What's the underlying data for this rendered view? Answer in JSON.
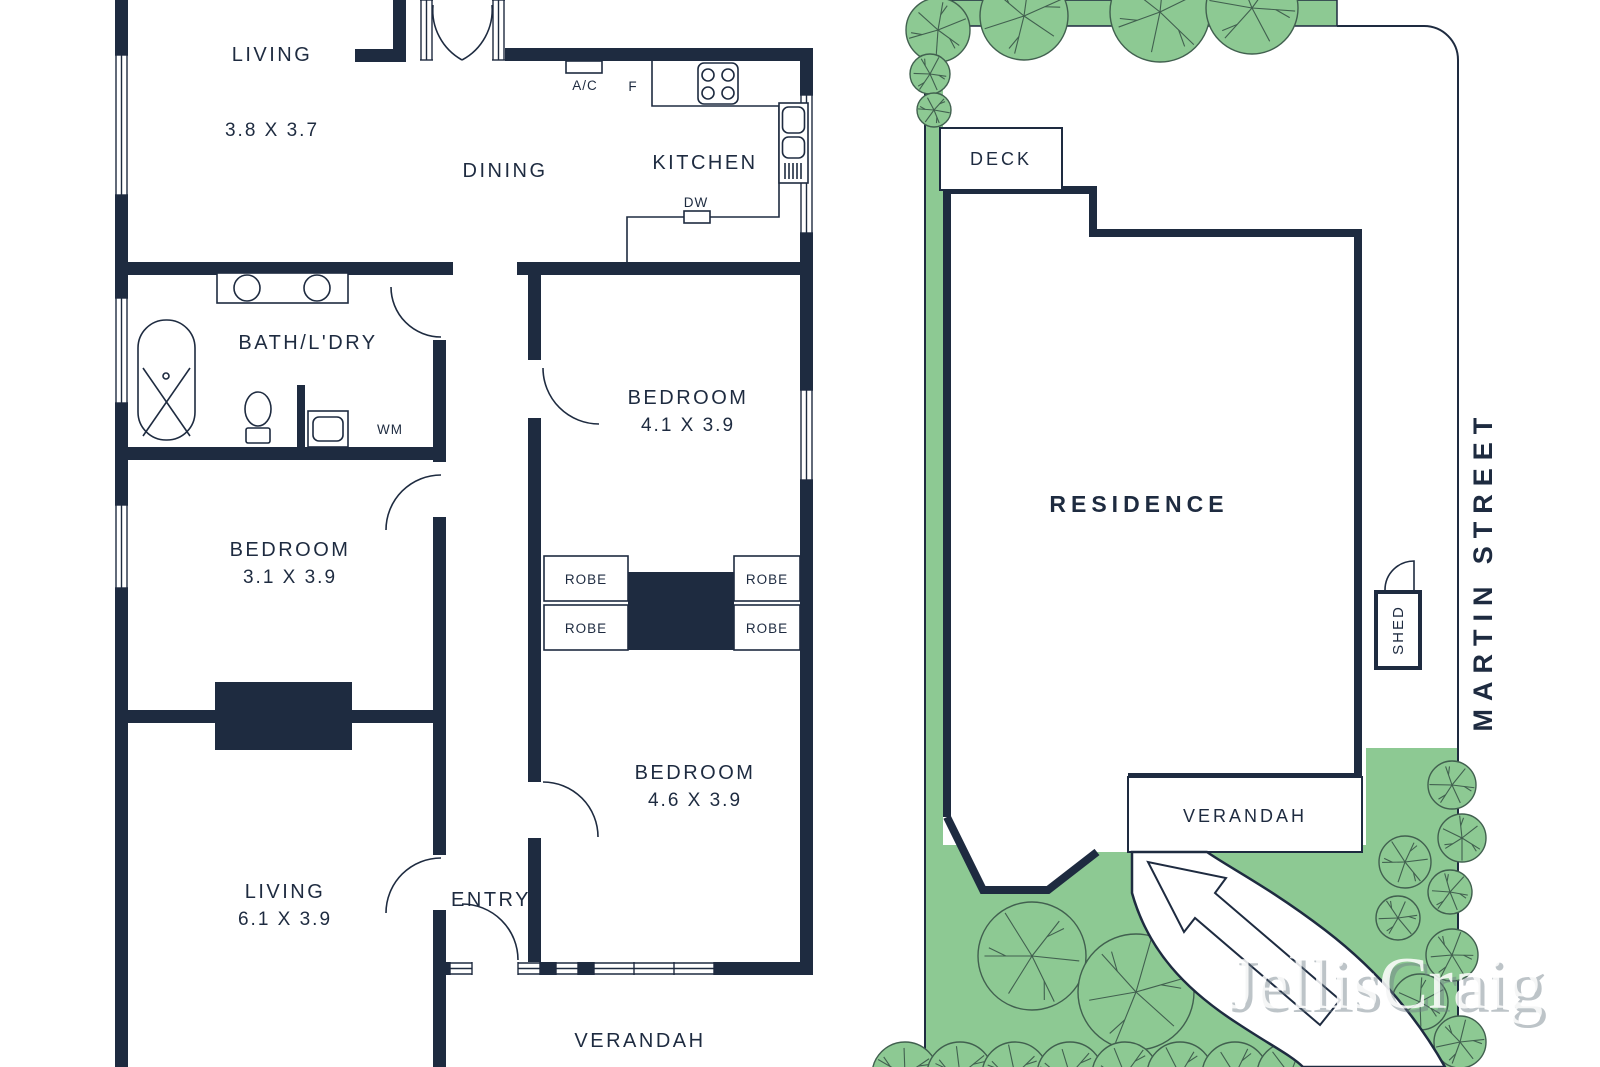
{
  "colors": {
    "wall": "#1e2b40",
    "grass": "#8dc993",
    "tree_outline": "#41604f",
    "paper": "#ffffff"
  },
  "floor_plan": {
    "rooms": {
      "living_top": {
        "name": "LIVING",
        "dims": "3.8 X 3.7"
      },
      "dining": {
        "name": "DINING"
      },
      "kitchen": {
        "name": "KITCHEN"
      },
      "bath_laundry": {
        "name": "BATH/L'DRY"
      },
      "bedroom_1": {
        "name": "BEDROOM",
        "dims": "4.1 X 3.9"
      },
      "bedroom_2": {
        "name": "BEDROOM",
        "dims": "3.1 X 3.9"
      },
      "bedroom_3": {
        "name": "BEDROOM",
        "dims": "4.6 X 3.9"
      },
      "living_bottom": {
        "name": "LIVING",
        "dims": "6.1 X 3.9"
      },
      "entry": {
        "name": "ENTRY"
      },
      "verandah": {
        "name": "VERANDAH"
      }
    },
    "labels": {
      "air_conditioner": "A/C",
      "fridge": "F",
      "dishwasher": "DW",
      "washing_machine": "WM",
      "robe": "ROBE"
    }
  },
  "site_plan": {
    "deck": "DECK",
    "residence": "RESIDENCE",
    "verandah": "VERANDAH",
    "shed": "SHED",
    "street_line1": "MARTIN",
    "street_line2": "STREET"
  },
  "watermark": "JellisCraig"
}
